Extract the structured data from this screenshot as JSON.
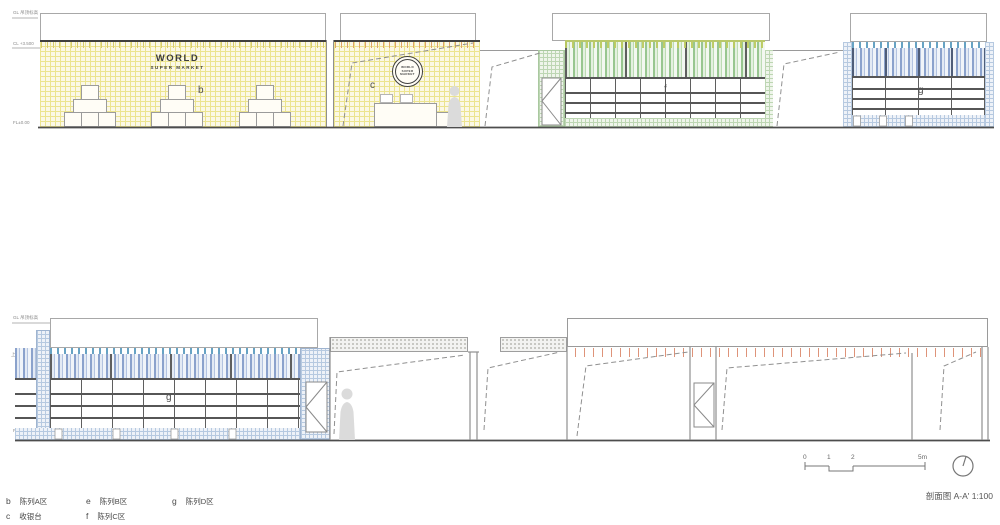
{
  "caption": "剖面图 A-A' 1:100",
  "sign": {
    "world": "WORLD",
    "subtitle": "SUPER MARKET"
  },
  "logo": {
    "l1": "WORLD",
    "l2": "SUPER",
    "l3": "MARKET"
  },
  "zones": {
    "b": "b",
    "c": "c",
    "f": "f",
    "g_top": "g",
    "g_bottom": "g"
  },
  "markers": {
    "top_ceiling": "GL 吊顶标高",
    "top_mid": "CL +3.500",
    "top_floor": "FL±0.00",
    "bottom_ceiling": "GL 吊顶标高",
    "bottom_mid": "上翻线",
    "bottom_floor": "FL±0.00",
    "dim_3350": "3350"
  },
  "legend": {
    "items": [
      {
        "key": "b",
        "label": "陈列A区"
      },
      {
        "key": "c",
        "label": "收银台"
      },
      {
        "key": "e",
        "label": "陈列B区"
      },
      {
        "key": "f",
        "label": "陈列C区"
      },
      {
        "key": "g",
        "label": "陈列D区"
      }
    ]
  },
  "scalebar": {
    "ticks": [
      "0",
      "1",
      "2",
      "5m"
    ]
  },
  "colors": {
    "wall_yellow": "#fbf8e6",
    "stripe_green": "#98c690",
    "stripe_blue": "#8ba2cc",
    "tick_orange": "#e0a468",
    "tick_salmon": "#de9379",
    "linework": "#8f8f8f",
    "shelf_line": "#565656"
  }
}
